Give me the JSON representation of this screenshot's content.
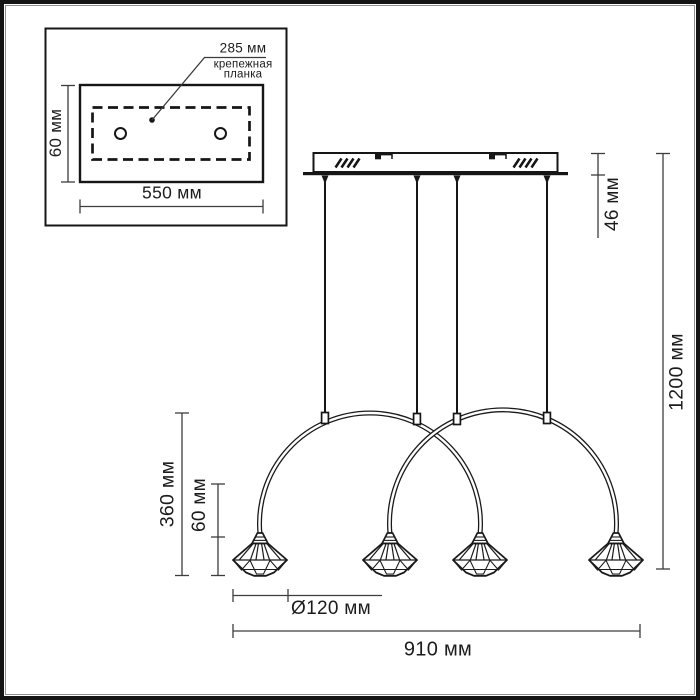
{
  "diagram": {
    "inset": {
      "hole_spacing": "285 мм",
      "part_label": "крепежная\nпланка",
      "plate_height": "60 мм",
      "plate_width": "550 мм"
    },
    "main": {
      "canopy_height": "46 мм",
      "overall_height": "1200 мм",
      "arc_drop": "360 мм",
      "shade_height": "60 мм",
      "shade_diameter": "Ø120 мм",
      "overall_width": "910 мм"
    }
  },
  "colors": {
    "line": "#1a1a1a",
    "dimension_line": "#3d3d3d",
    "background": "#ffffff"
  }
}
